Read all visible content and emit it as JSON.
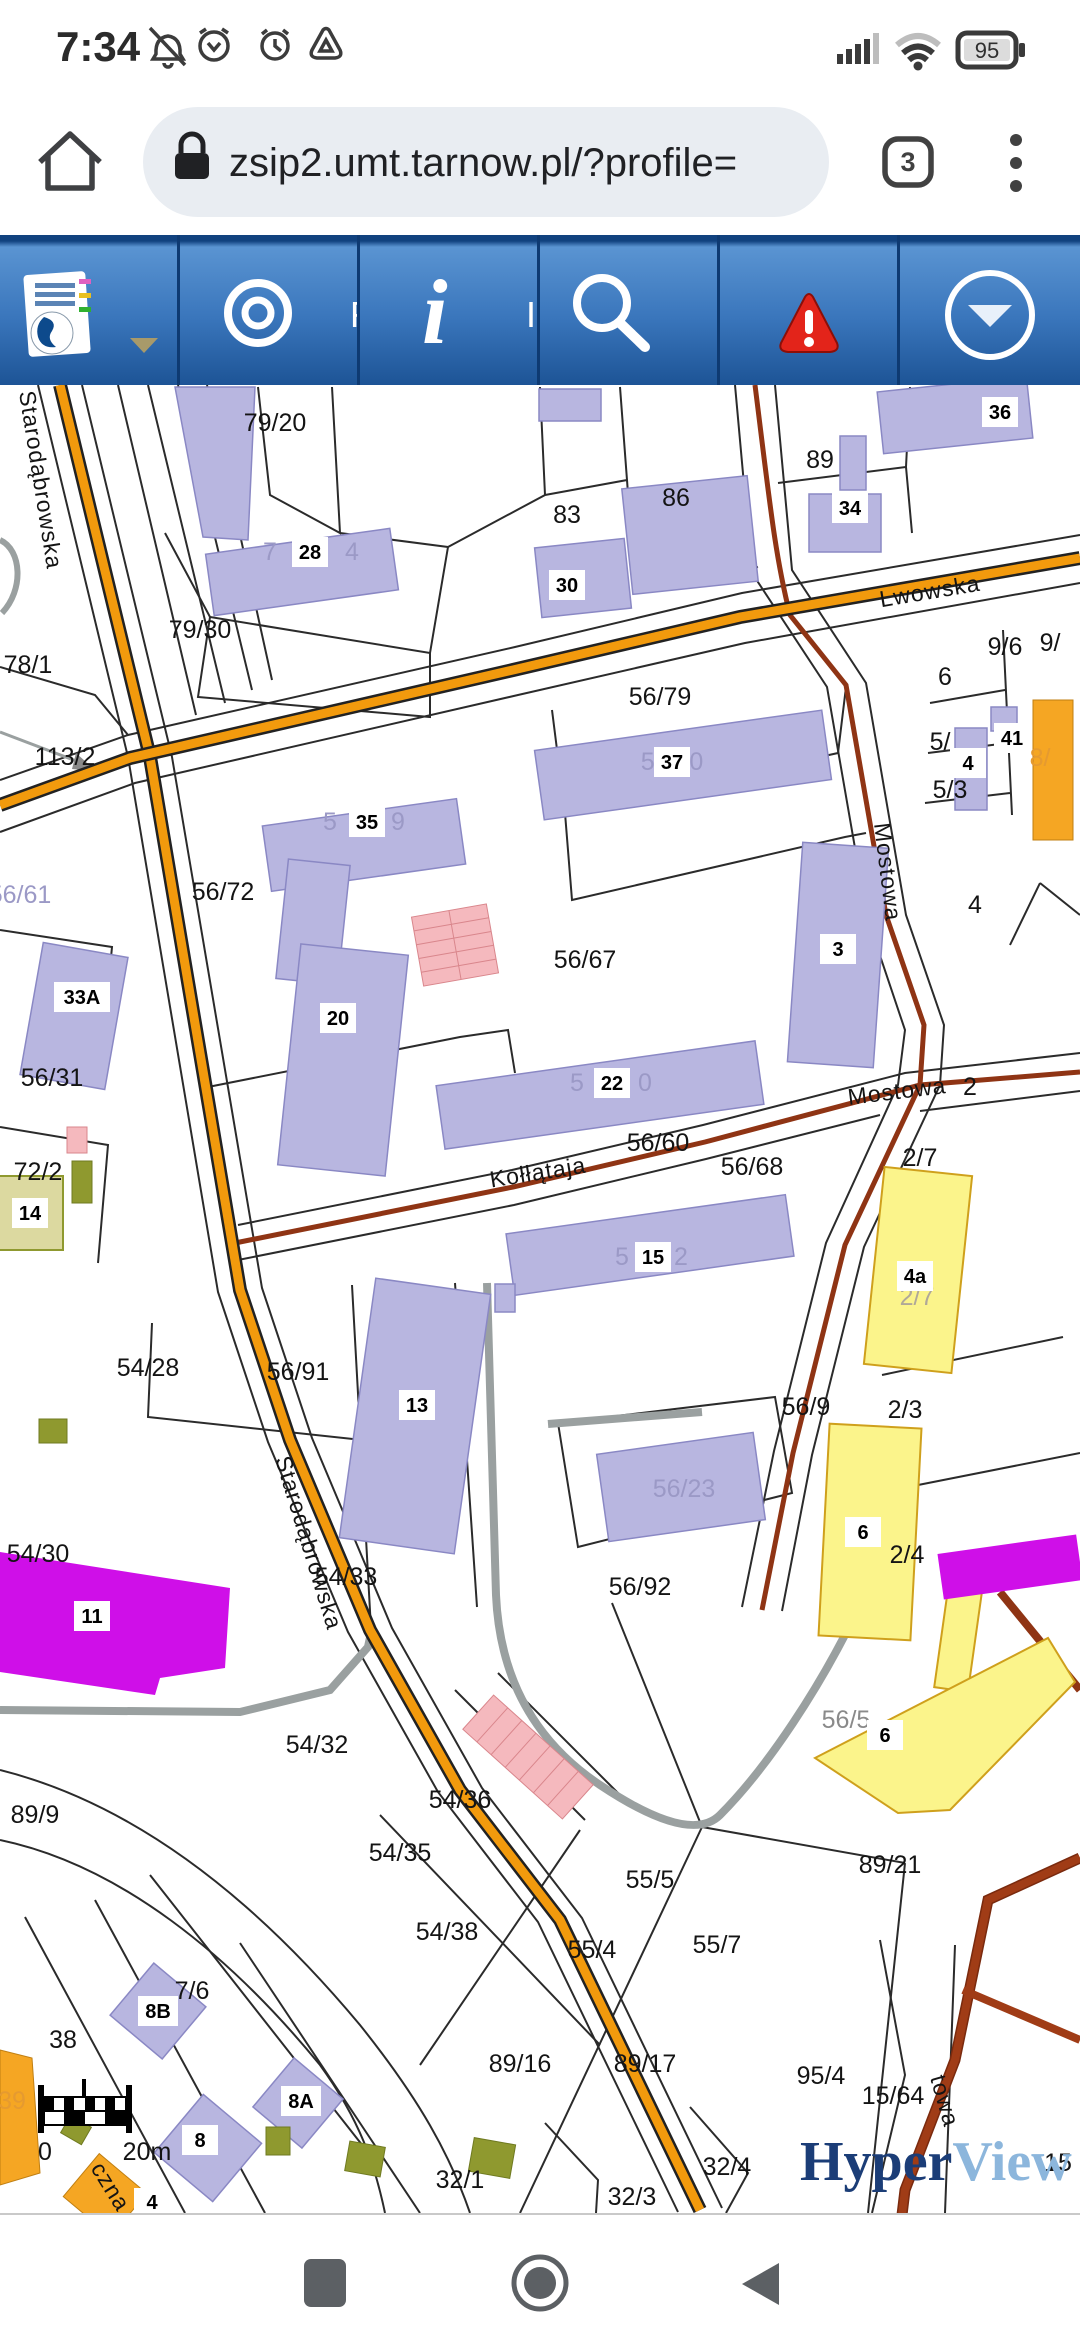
{
  "status_bar": {
    "time": "7:34",
    "battery_level": "95"
  },
  "browser": {
    "url": "zsip2.umt.tarnow.pl/?profile=",
    "tab_count": "3"
  },
  "toolbar": {
    "buttons": [
      {
        "name": "layers-legend"
      },
      {
        "name": "locate-target",
        "partial_label": "F"
      },
      {
        "name": "info",
        "partial_label": "I"
      },
      {
        "name": "search"
      },
      {
        "name": "alerts"
      },
      {
        "name": "expand"
      }
    ]
  },
  "map": {
    "streets": [
      {
        "text": "Lwowska"
      },
      {
        "text": "Mostowa"
      },
      {
        "text": "Mostowa"
      },
      {
        "text": "Kołłątaja"
      },
      {
        "text": "Starodąbrowska"
      },
      {
        "text": "Starodąbrowska"
      },
      {
        "text": "czna"
      },
      {
        "text": "towa"
      }
    ],
    "parcel_labels": [
      {
        "text": "79/20"
      },
      {
        "text": "89"
      },
      {
        "text": "83"
      },
      {
        "text": "86"
      },
      {
        "text": "79/30"
      },
      {
        "text": "78/1"
      },
      {
        "text": "113/2"
      },
      {
        "text": "56/79"
      },
      {
        "text": "9/6"
      },
      {
        "text": "9/"
      },
      {
        "text": "6"
      },
      {
        "text": "5/"
      },
      {
        "text": "5/3"
      },
      {
        "text": "4"
      },
      {
        "text": "56/72"
      },
      {
        "text": "56/67"
      },
      {
        "text": "56/31"
      },
      {
        "text": "72/2"
      },
      {
        "text": "56/60"
      },
      {
        "text": "56/68"
      },
      {
        "text": "2/7"
      },
      {
        "text": "2"
      },
      {
        "text": "2/3"
      },
      {
        "text": "2/4"
      },
      {
        "text": "56/9"
      },
      {
        "text": "56/92"
      },
      {
        "text": "54/28"
      },
      {
        "text": "56/91"
      },
      {
        "text": "54/33"
      },
      {
        "text": "54/30"
      },
      {
        "text": "54/32"
      },
      {
        "text": "89/9"
      },
      {
        "text": "54/36"
      },
      {
        "text": "54/35"
      },
      {
        "text": "55/5"
      },
      {
        "text": "54/38"
      },
      {
        "text": "55/4"
      },
      {
        "text": "55/7"
      },
      {
        "text": "89/21"
      },
      {
        "text": "89/16"
      },
      {
        "text": "89/17"
      },
      {
        "text": "95/4"
      },
      {
        "text": "15/64"
      },
      {
        "text": "32/4"
      },
      {
        "text": "32/3"
      },
      {
        "text": "32/1"
      },
      {
        "text": "38"
      },
      {
        "text": "7/6"
      },
      {
        "text": "15"
      }
    ],
    "building_numbers": [
      {
        "text": "28"
      },
      {
        "text": "36"
      },
      {
        "text": "34"
      },
      {
        "text": "30"
      },
      {
        "text": "37"
      },
      {
        "text": "35"
      },
      {
        "text": "3"
      },
      {
        "text": "4"
      },
      {
        "text": "41"
      },
      {
        "text": "20"
      },
      {
        "text": "33A"
      },
      {
        "text": "22"
      },
      {
        "text": "14"
      },
      {
        "text": "15"
      },
      {
        "text": "13"
      },
      {
        "text": "11"
      },
      {
        "text": "4a"
      },
      {
        "text": "6"
      },
      {
        "text": "6"
      },
      {
        "text": "8B"
      },
      {
        "text": "8"
      },
      {
        "text": "8A"
      },
      {
        "text": "4"
      }
    ],
    "ghost_labels": [
      {
        "text": "7"
      },
      {
        "text": "4"
      },
      {
        "text": "56/80"
      },
      {
        "text": "5"
      },
      {
        "text": "9"
      },
      {
        "text": "56/61"
      },
      {
        "text": "5"
      },
      {
        "text": "0"
      },
      {
        "text": "5"
      },
      {
        "text": "2"
      },
      {
        "text": "56/23"
      },
      {
        "text": "2/7"
      },
      {
        "text": "56/5"
      },
      {
        "text": "8/"
      },
      {
        "text": "39"
      }
    ],
    "scale_bar": {
      "start": "0",
      "end": "20m"
    },
    "watermark": {
      "hyper": "Hyper",
      "view": "View"
    },
    "colors": {
      "toolbar_blue": "#2e6db4",
      "road_orange": "#f29a0d",
      "road_red": "#8f3414",
      "building_lavender": "#b8b6e0",
      "building_pink": "#f5b9be",
      "building_yellow": "#fbf48b",
      "building_magenta": "#cf0fe8",
      "building_orange": "#f5a623",
      "building_olive": "#8f992f",
      "hyper_navy": "#1b3d77",
      "view_blue": "#8cb6dc"
    }
  }
}
